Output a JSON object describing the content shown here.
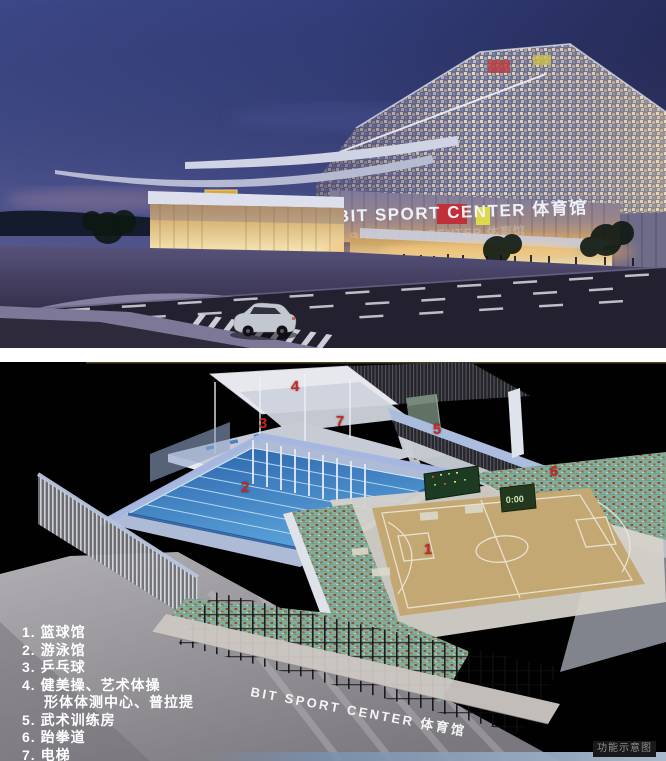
{
  "exterior": {
    "building_sign": "BIT SPORT CENTER 体育馆"
  },
  "interior": {
    "facade_sign": "BIT SPORT CENTER 体育馆",
    "scoreboard_time": "0:00",
    "caption": "功能示意图",
    "markers": [
      "1",
      "2",
      "3",
      "4",
      "5",
      "6",
      "7"
    ],
    "legend_lines": [
      "1. 篮球馆",
      "2. 游泳馆",
      "3. 乒乓球",
      "4. 健美操、艺术体操",
      "形体体测中心、普拉提",
      "5. 武术训练房",
      "6. 跆拳道",
      "7. 电梯"
    ],
    "colors": {
      "marker_red": "#c9261f",
      "pool_blue": "#3f7fc0",
      "court_wood": "#c4a873",
      "stand_teal": "#7fae9c",
      "legend_text": "#ffffff"
    }
  }
}
